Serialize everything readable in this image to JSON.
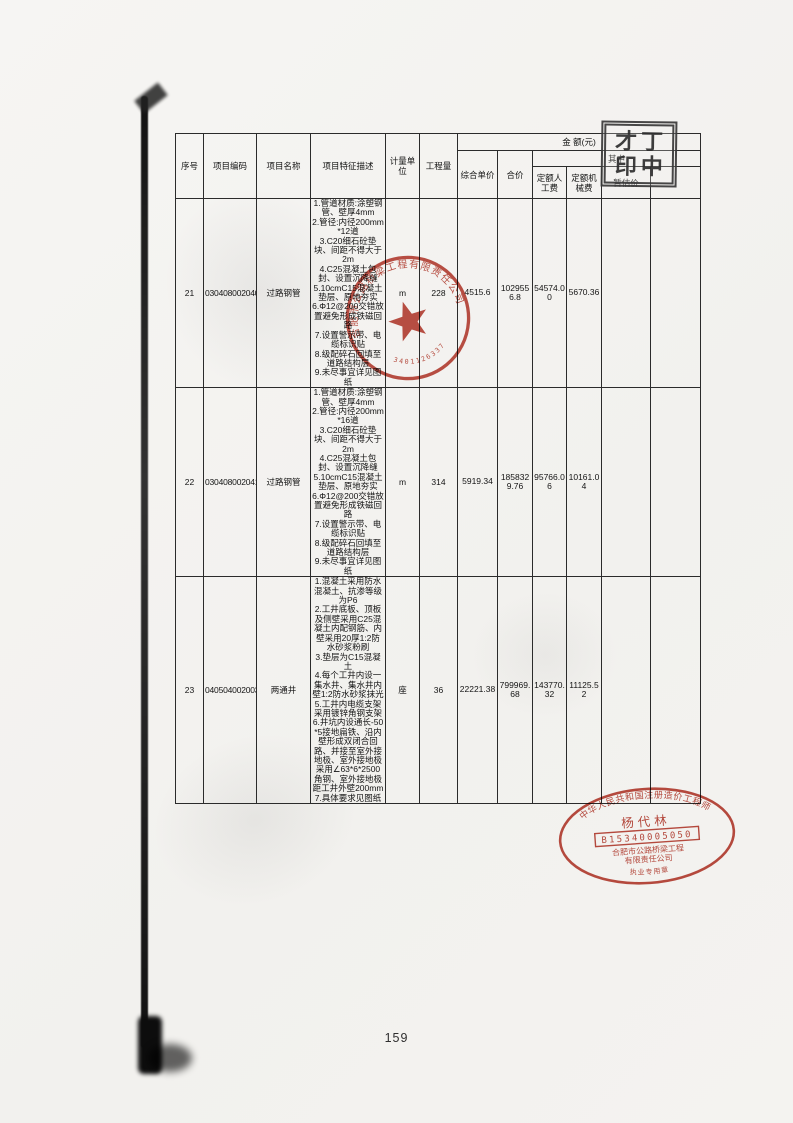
{
  "page": {
    "number": "159"
  },
  "table": {
    "header": {
      "seq": "序号",
      "code": "项目编码",
      "name": "项目名称",
      "features": "项目特征描述",
      "unit": "计量单位",
      "quantity": "工程量",
      "amount_group": "金  额(元)",
      "unit_price": "综合单价",
      "total_price": "合价",
      "among": "其中",
      "labor": "定额人工费",
      "machine": "定额机械费",
      "estimate": "暂估价"
    },
    "rows": [
      {
        "seq": "21",
        "code": "030408002040",
        "name": "过路钢管",
        "features": "1.管道材质:涂塑钢管、壁厚4mm\n2.管径:内径200mm*12道\n3.C20细石砼垫块、间距不得大于2m\n4.C25混凝土包封、设置沉降缝\n5.10cmC15混凝土垫层、原地夯实\n6.Φ12@200交错放置避免形成铁磁回路\n7.设置警示带、电缆标识贴\n8.级配碎石回填至道路结构层\n9.未尽事宜详见图纸",
        "unit": "m",
        "quantity": "228",
        "unit_price": "4515.6",
        "total_price": "1029556.8",
        "labor": "54574.00",
        "machine": "5670.36"
      },
      {
        "seq": "22",
        "code": "030408002041",
        "name": "过路钢管",
        "features": "1.管道材质:涂塑钢管、壁厚4mm\n2.管径:内径200mm*16道\n3.C20细石砼垫块、间距不得大于2m\n4.C25混凝土包封、设置沉降缝\n5.10cmC15混凝土垫层、原地夯实\n6.Φ12@200交错放置避免形成铁磁回路\n7.设置警示带、电缆标识贴\n8.级配碎石回填至道路结构层\n9.未尽事宜详见图纸",
        "unit": "m",
        "quantity": "314",
        "unit_price": "5919.34",
        "total_price": "1858329.76",
        "labor": "95766.06",
        "machine": "10161.04"
      },
      {
        "seq": "23",
        "code": "040504002003",
        "name": "两通井",
        "features": "1.混凝土采用防水混凝土、抗渗等级为P6\n2.工井底板、顶板及侧壁采用C25混凝土内配钢筋、内壁采用20厚1:2防水砂浆粉刷\n3.垫层为C15混凝土\n4.每个工井内设一集水井、集水井内壁1:2防水砂浆抹光\n5.工井内电缆支架采用镀锌角钢支架\n6.井坑内设通长-50*5接地扁铁、沿内壁形成双闭合回路、并接至室外接地极、室外接地极采用∠63*6*2500角钢、室外接地极距工井外壁200mm\n7.具体要求见图纸",
        "unit": "座",
        "quantity": "36",
        "unit_price": "22221.38",
        "total_price": "799969.68",
        "labor": "143770.32",
        "machine": "11125.52"
      }
    ]
  },
  "stamps": {
    "square": {
      "line1": "才丁",
      "line2": "印中"
    },
    "round": {
      "company": "合肥市公路桥梁工程有限责任公司",
      "number": "3401126337"
    },
    "oval": {
      "arc_top": "中华人民共和国注册造价工程师",
      "name": "杨代林",
      "number": "B15340005050",
      "org1": "合肥市公路桥梁工程",
      "org2": "有限责任公司",
      "bottom": "执业专用章"
    }
  }
}
